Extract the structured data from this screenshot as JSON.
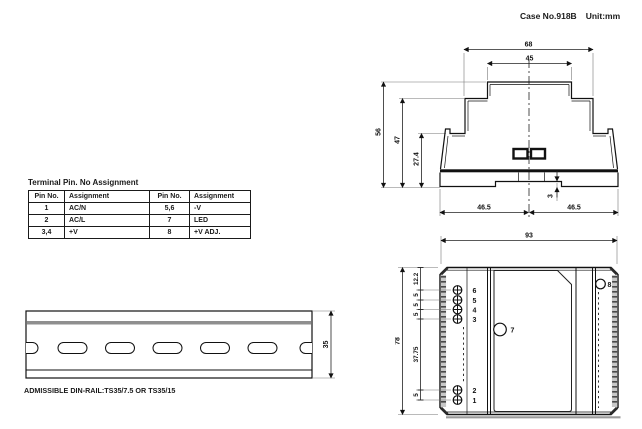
{
  "header": {
    "case_label": "Case No.918B",
    "unit_label": "Unit:mm"
  },
  "pin_table": {
    "title": "Terminal Pin. No Assignment",
    "headers": [
      "Pin No.",
      "Assignment",
      "Pin No.",
      "Assignment"
    ],
    "rows": [
      [
        "1",
        "AC/N",
        "5,6",
        "-V"
      ],
      [
        "2",
        "AC/L",
        "7",
        "LED"
      ],
      [
        "3,4",
        "+V",
        "8",
        "+V ADJ."
      ]
    ]
  },
  "front_view": {
    "dims": {
      "outer_width": "68",
      "top_width": "45",
      "total_height": "56",
      "upper_height": "47",
      "lower_height": "27.4",
      "base_left": "46.5",
      "base_right": "46.5",
      "rail_notch": "3"
    }
  },
  "top_view": {
    "dims": {
      "width": "93",
      "height": "78",
      "chain": [
        "12.2",
        "5",
        "5",
        "5",
        "37.75",
        "5"
      ]
    },
    "pin_labels": [
      "6",
      "5",
      "4",
      "3",
      "2",
      "1"
    ],
    "led_label": "7",
    "adj_label": "8"
  },
  "din_rail": {
    "dims": {
      "height": "35"
    },
    "caption": "ADMISSIBLE DIN-RAIL:TS35/7.5 OR TS35/15"
  }
}
